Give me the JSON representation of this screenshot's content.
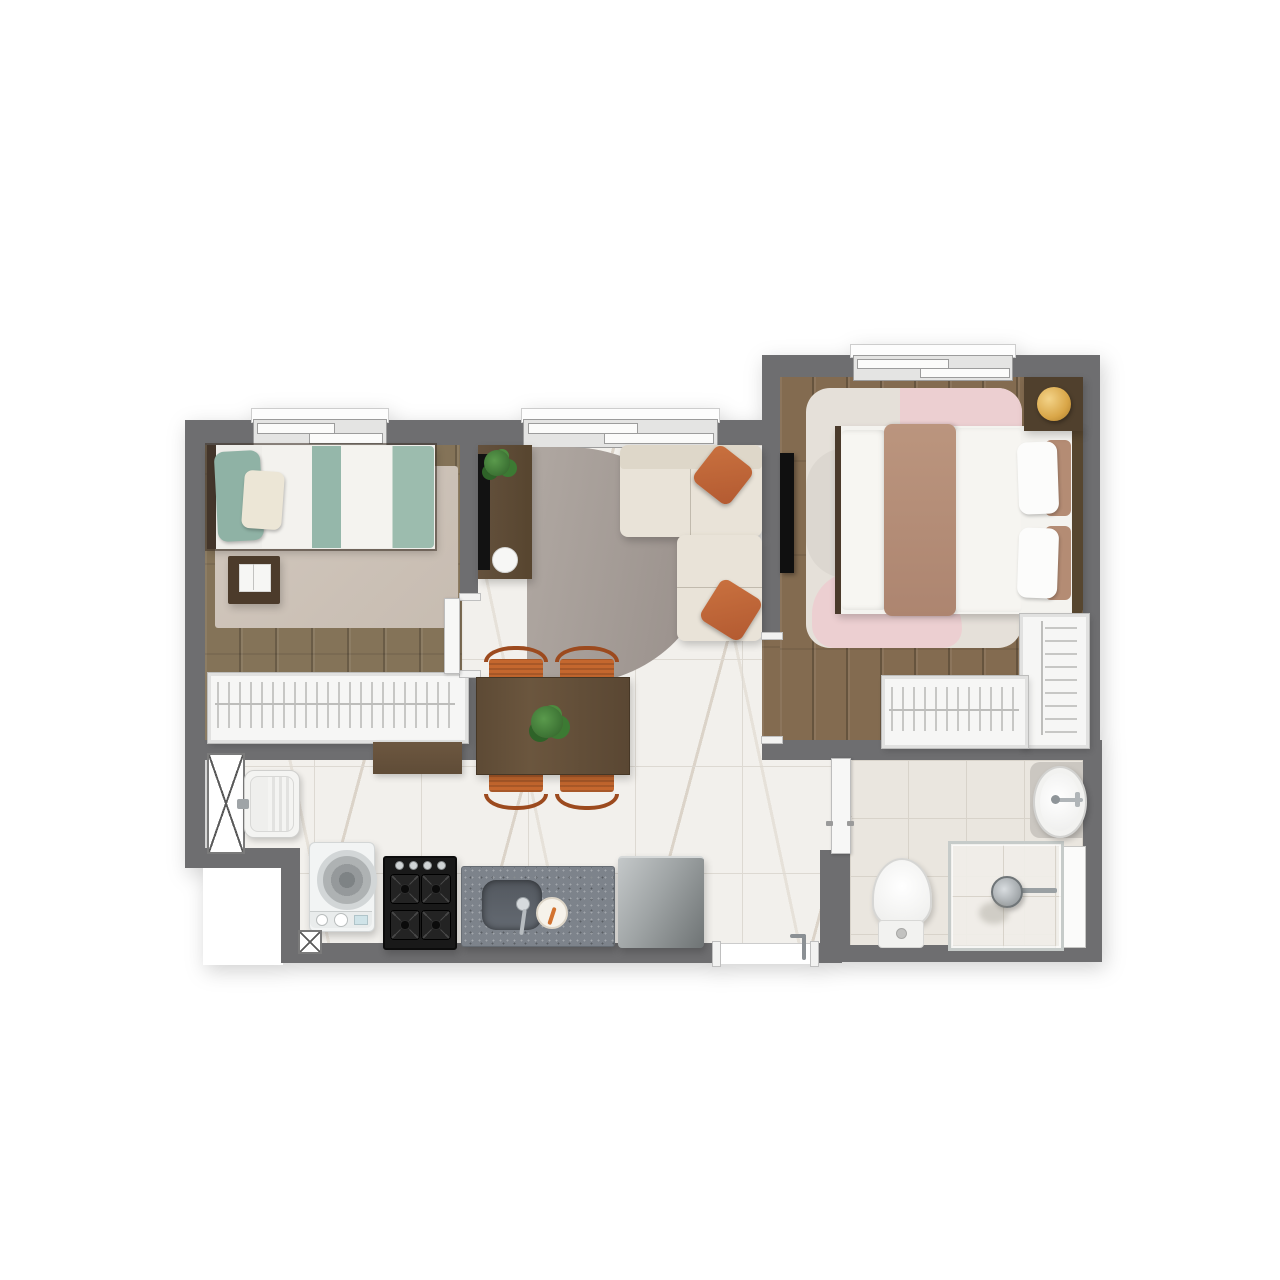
{
  "meta": {
    "type": "apartment-floor-plan",
    "style": "top-down 3d rendered plan on white background",
    "canvas": {
      "width": 1280,
      "height": 1280
    }
  },
  "palette": {
    "background": "#ffffff",
    "wall": "#6e6e70",
    "marble_floor": "#f2f0ec",
    "wood_floor_bedroom1": "#8b795d",
    "wood_floor_master": "#8a7154",
    "bathroom_tile": "#eae6df",
    "sofa_cream": "#e9e3d8",
    "terracotta_pillow": "#bf673c",
    "bedding_green": "#98b8ab",
    "rug_beige": "#cdc3b9",
    "rug_gray": "#a7a09b",
    "rug_master_cream": "#e5e0d9",
    "rug_master_pink": "#eccfd1",
    "table_wood": "#63503a",
    "chair_orange": "#c4672e",
    "granite_counter": "#7d838b",
    "stove_black": "#191919",
    "fridge_steel": "#9fa4a5",
    "lamp_gold": "#d9a648",
    "blanket_tan": "#b58e76"
  },
  "rooms": [
    {
      "id": "bedroom-1",
      "floor": "wood",
      "contents": [
        "single-bed",
        "green-white-bedding",
        "green-pillow",
        "cream-pillow",
        "beige-rug",
        "bedside-table-with-book",
        "wardrobe-hanging-rack",
        "sliding-window",
        "door"
      ]
    },
    {
      "id": "living-room",
      "floor": "marble",
      "contents": [
        "l-shaped-cream-sofa",
        "two-terracotta-pillows",
        "semicircular-gray-rug",
        "tv-console",
        "wall-tv",
        "potted-plant",
        "round-dish",
        "sliding-window"
      ]
    },
    {
      "id": "dining-area",
      "floor": "marble",
      "contents": [
        "rectangular-wood-table",
        "four-orange-rattan-chairs",
        "center-plant",
        "side-counter"
      ]
    },
    {
      "id": "kitchen",
      "floor": "marble",
      "contents": [
        "granite-sink-counter",
        "kitchen-faucet",
        "bowl-with-utensil",
        "gas-stove-4-burners",
        "refrigerator"
      ]
    },
    {
      "id": "laundry",
      "floor": "marble",
      "contents": [
        "utility-sink",
        "top-load-washing-machine",
        "hatched-duct-shaft",
        "small-hatched-gas-point"
      ]
    },
    {
      "id": "hall",
      "floor": "marble",
      "contents": [
        "entry-door-opening",
        "door-handle"
      ]
    },
    {
      "id": "master-bedroom",
      "floor": "wood",
      "contents": [
        "double-bed",
        "tan-throw-blanket",
        "four-pillows",
        "organic-cream-pink-rug",
        "nightstand",
        "gold-lamp",
        "wall-tv",
        "l-shaped-closet",
        "sliding-window",
        "door"
      ]
    },
    {
      "id": "bathroom",
      "floor": "ceramic-tile",
      "contents": [
        "toilet",
        "oval-washbasin",
        "basin-faucet",
        "glass-shower-enclosure",
        "shower-head",
        "door",
        "vent-window"
      ]
    }
  ],
  "counts": {
    "bedrooms": 2,
    "bathrooms": 1,
    "sliding_windows": 3,
    "doors": 4
  }
}
